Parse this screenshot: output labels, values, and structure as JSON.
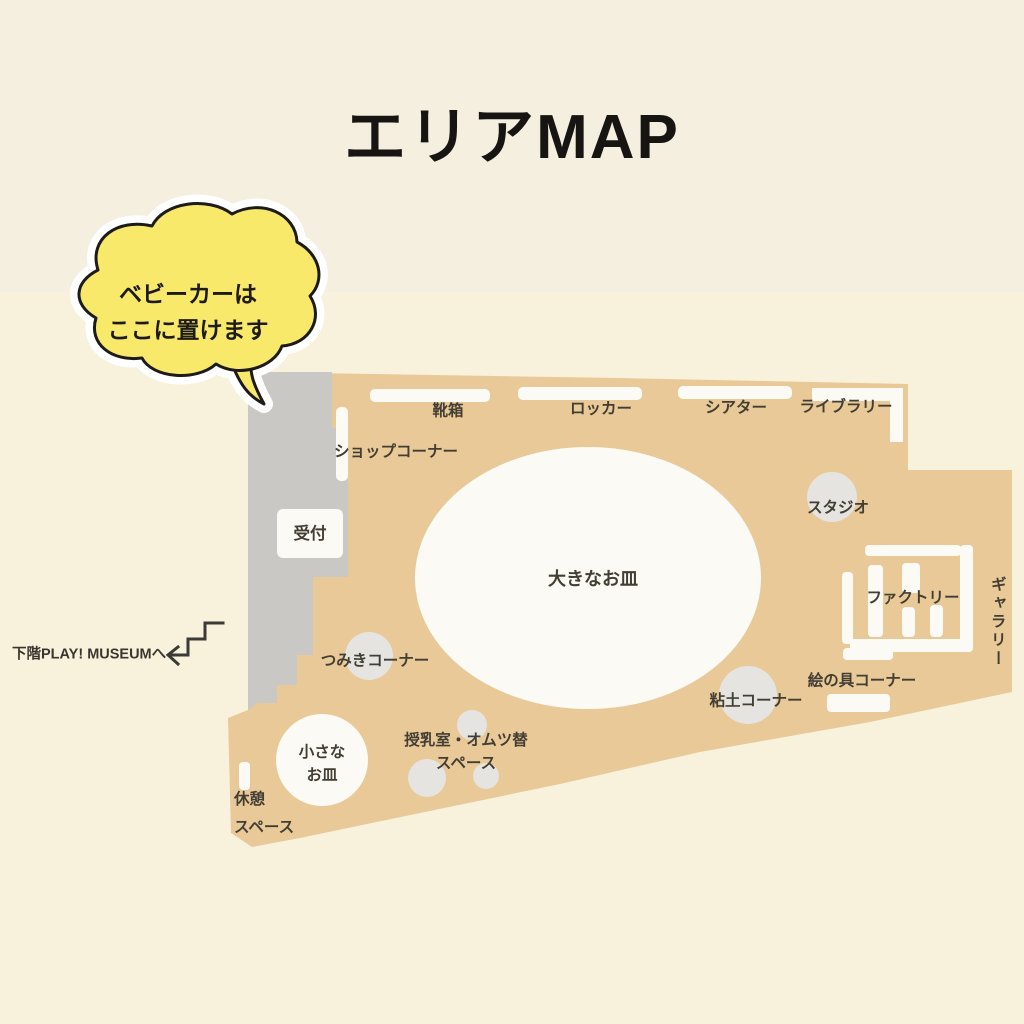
{
  "page": {
    "title": "エリアMAP"
  },
  "bubble": {
    "line1": "ベビーカーは",
    "line2": "ここに置けます",
    "color": "#f8e96a"
  },
  "downstairs": {
    "label": "下階PLAY! MUSEUMへ"
  },
  "map": {
    "colors": {
      "floor": "#e9c997",
      "stroller_zone": "#c9c8c4",
      "furniture": "#fbfaf4",
      "blob": "#e5e4e0",
      "background": "#f5efe0"
    },
    "areas": {
      "shoe_box": "靴箱",
      "locker": "ロッカー",
      "theater": "シアター",
      "library": "ライブラリー",
      "shop_corner": "ショップコーナー",
      "reception": "受付",
      "studio": "スタジオ",
      "big_plate": "大きなお皿",
      "factory": "ファクトリー",
      "gallery": "ギャラリー",
      "paint_corner": "絵の具コーナー",
      "clay_corner": "粘土コーナー",
      "blocks_corner": "つみきコーナー",
      "small_plate_line1": "小さな",
      "small_plate_line2": "お皿",
      "nursing_line1": "授乳室・オムツ替",
      "nursing_line2": "スペース",
      "rest_line1": "休憩",
      "rest_line2": "スペース"
    }
  }
}
